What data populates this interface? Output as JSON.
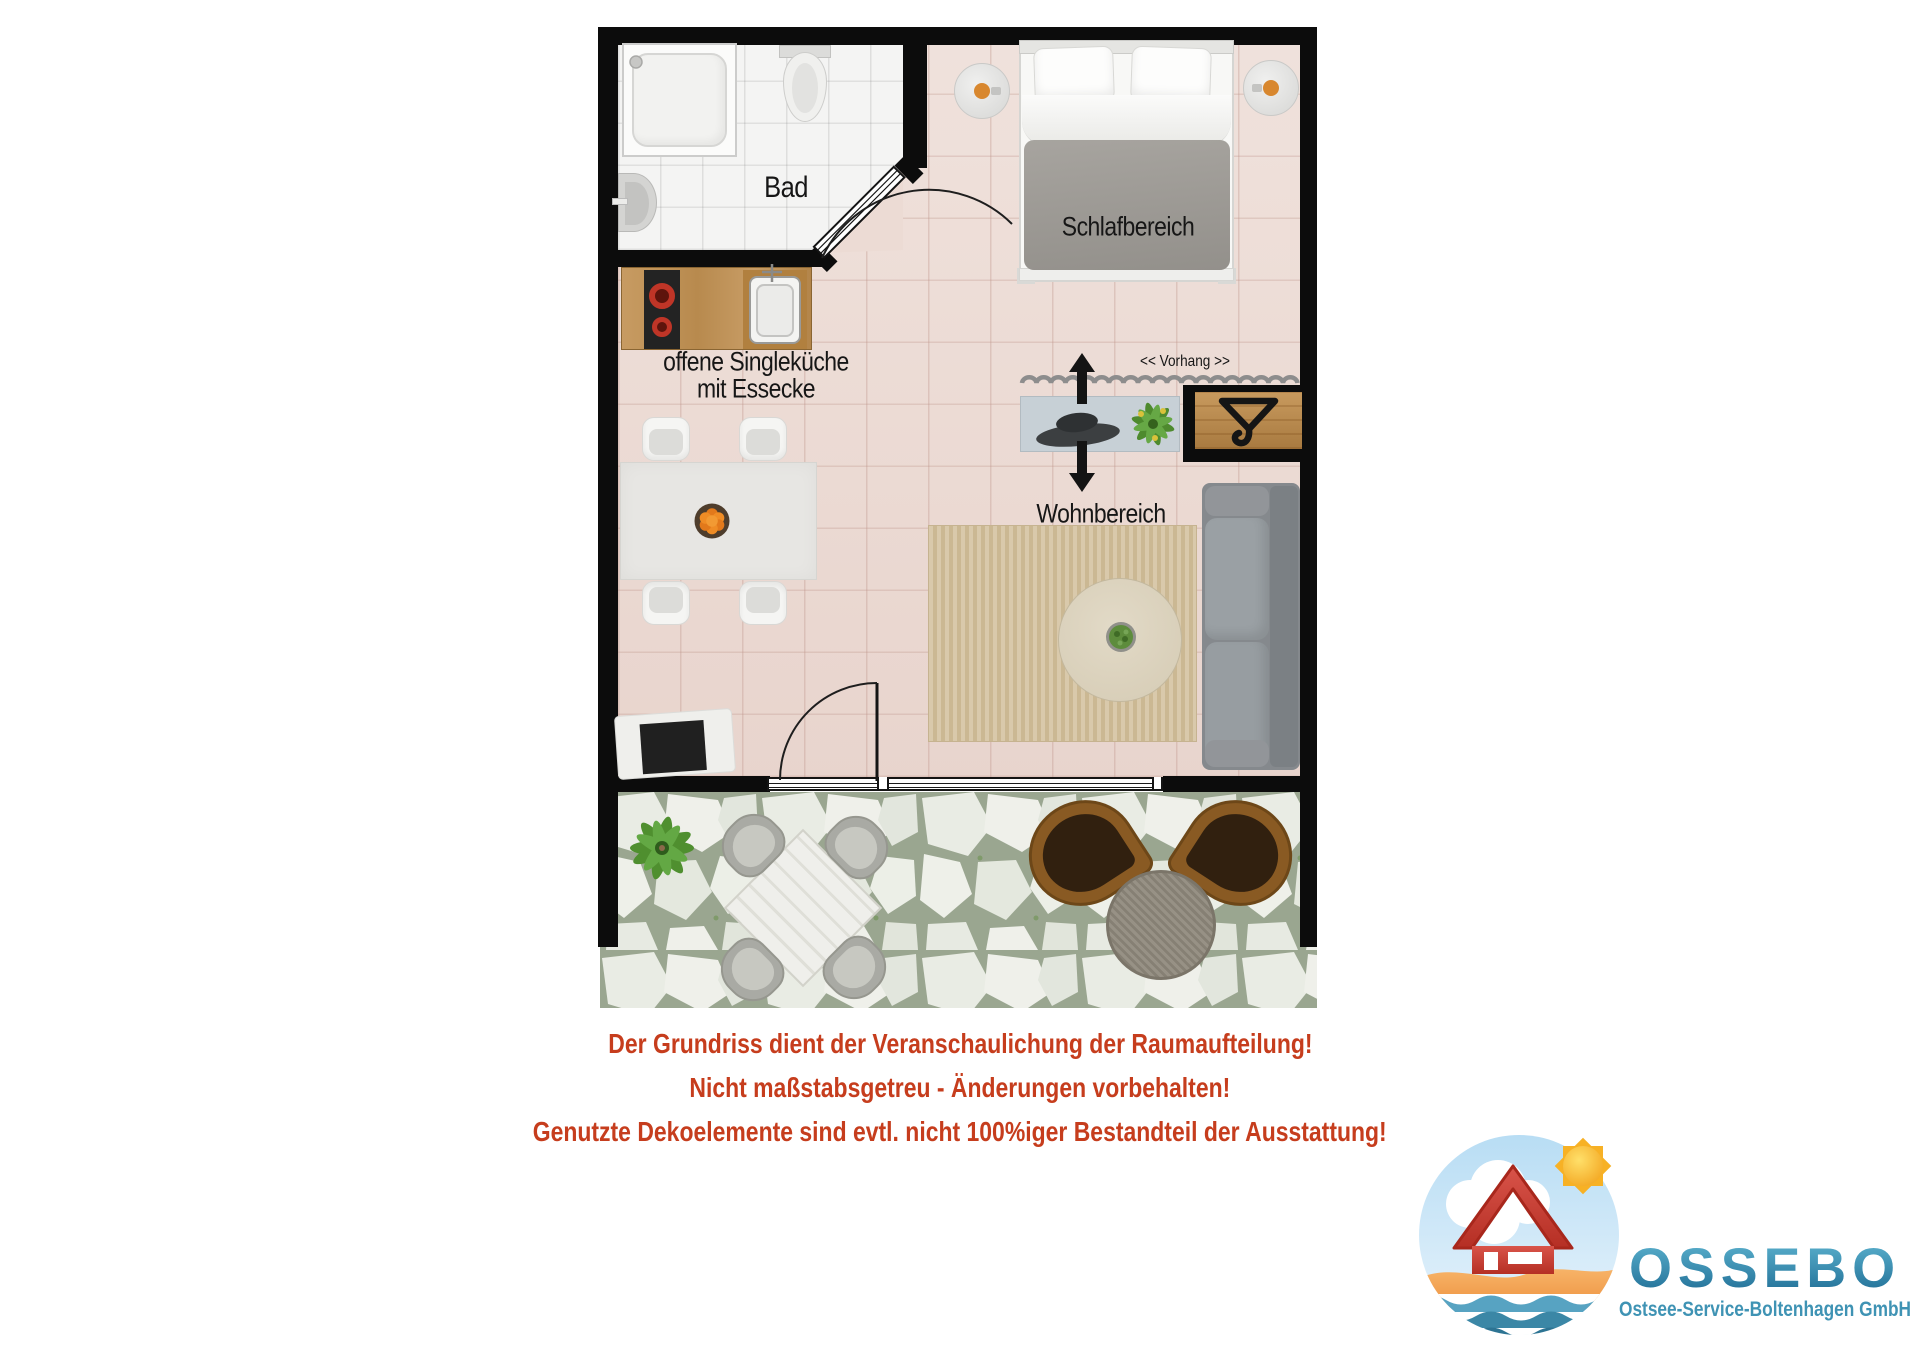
{
  "plan": {
    "labels": {
      "bath": "Bad",
      "sleep": "Schlafbereich",
      "kitchen_line1": "offene Singleküche",
      "kitchen_line2": "mit Essecke",
      "living": "Wohnbereich",
      "curtain": "<< Vorhang >>"
    },
    "colors": {
      "wall": "#0c0c0c",
      "floor_main": "#ecdbd4",
      "floor_bath": "#f4f4f3",
      "rug": "#d4c3a1",
      "sofa": "#85898d",
      "wood": "#bf9257",
      "terrace_stone_grout": "#9aa690"
    }
  },
  "disclaimer": {
    "color": "#c63d1d",
    "line1": "Der Grundriss dient der Veranschaulichung der Raumaufteilung!",
    "line2": "Nicht maßstabsgetreu - Änderungen vorbehalten!",
    "line3": "Genutzte Dekoelemente sind evtl. nicht 100%iger Bestandteil der Ausstattung!"
  },
  "logo": {
    "name": "OSSEBO",
    "subtitle": "Ostsee-Service-Boltenhagen GmbH",
    "name_color_top": "#5fb6d2",
    "name_color_bottom": "#1d6a92",
    "subtitle_color": "#3f93b4"
  }
}
